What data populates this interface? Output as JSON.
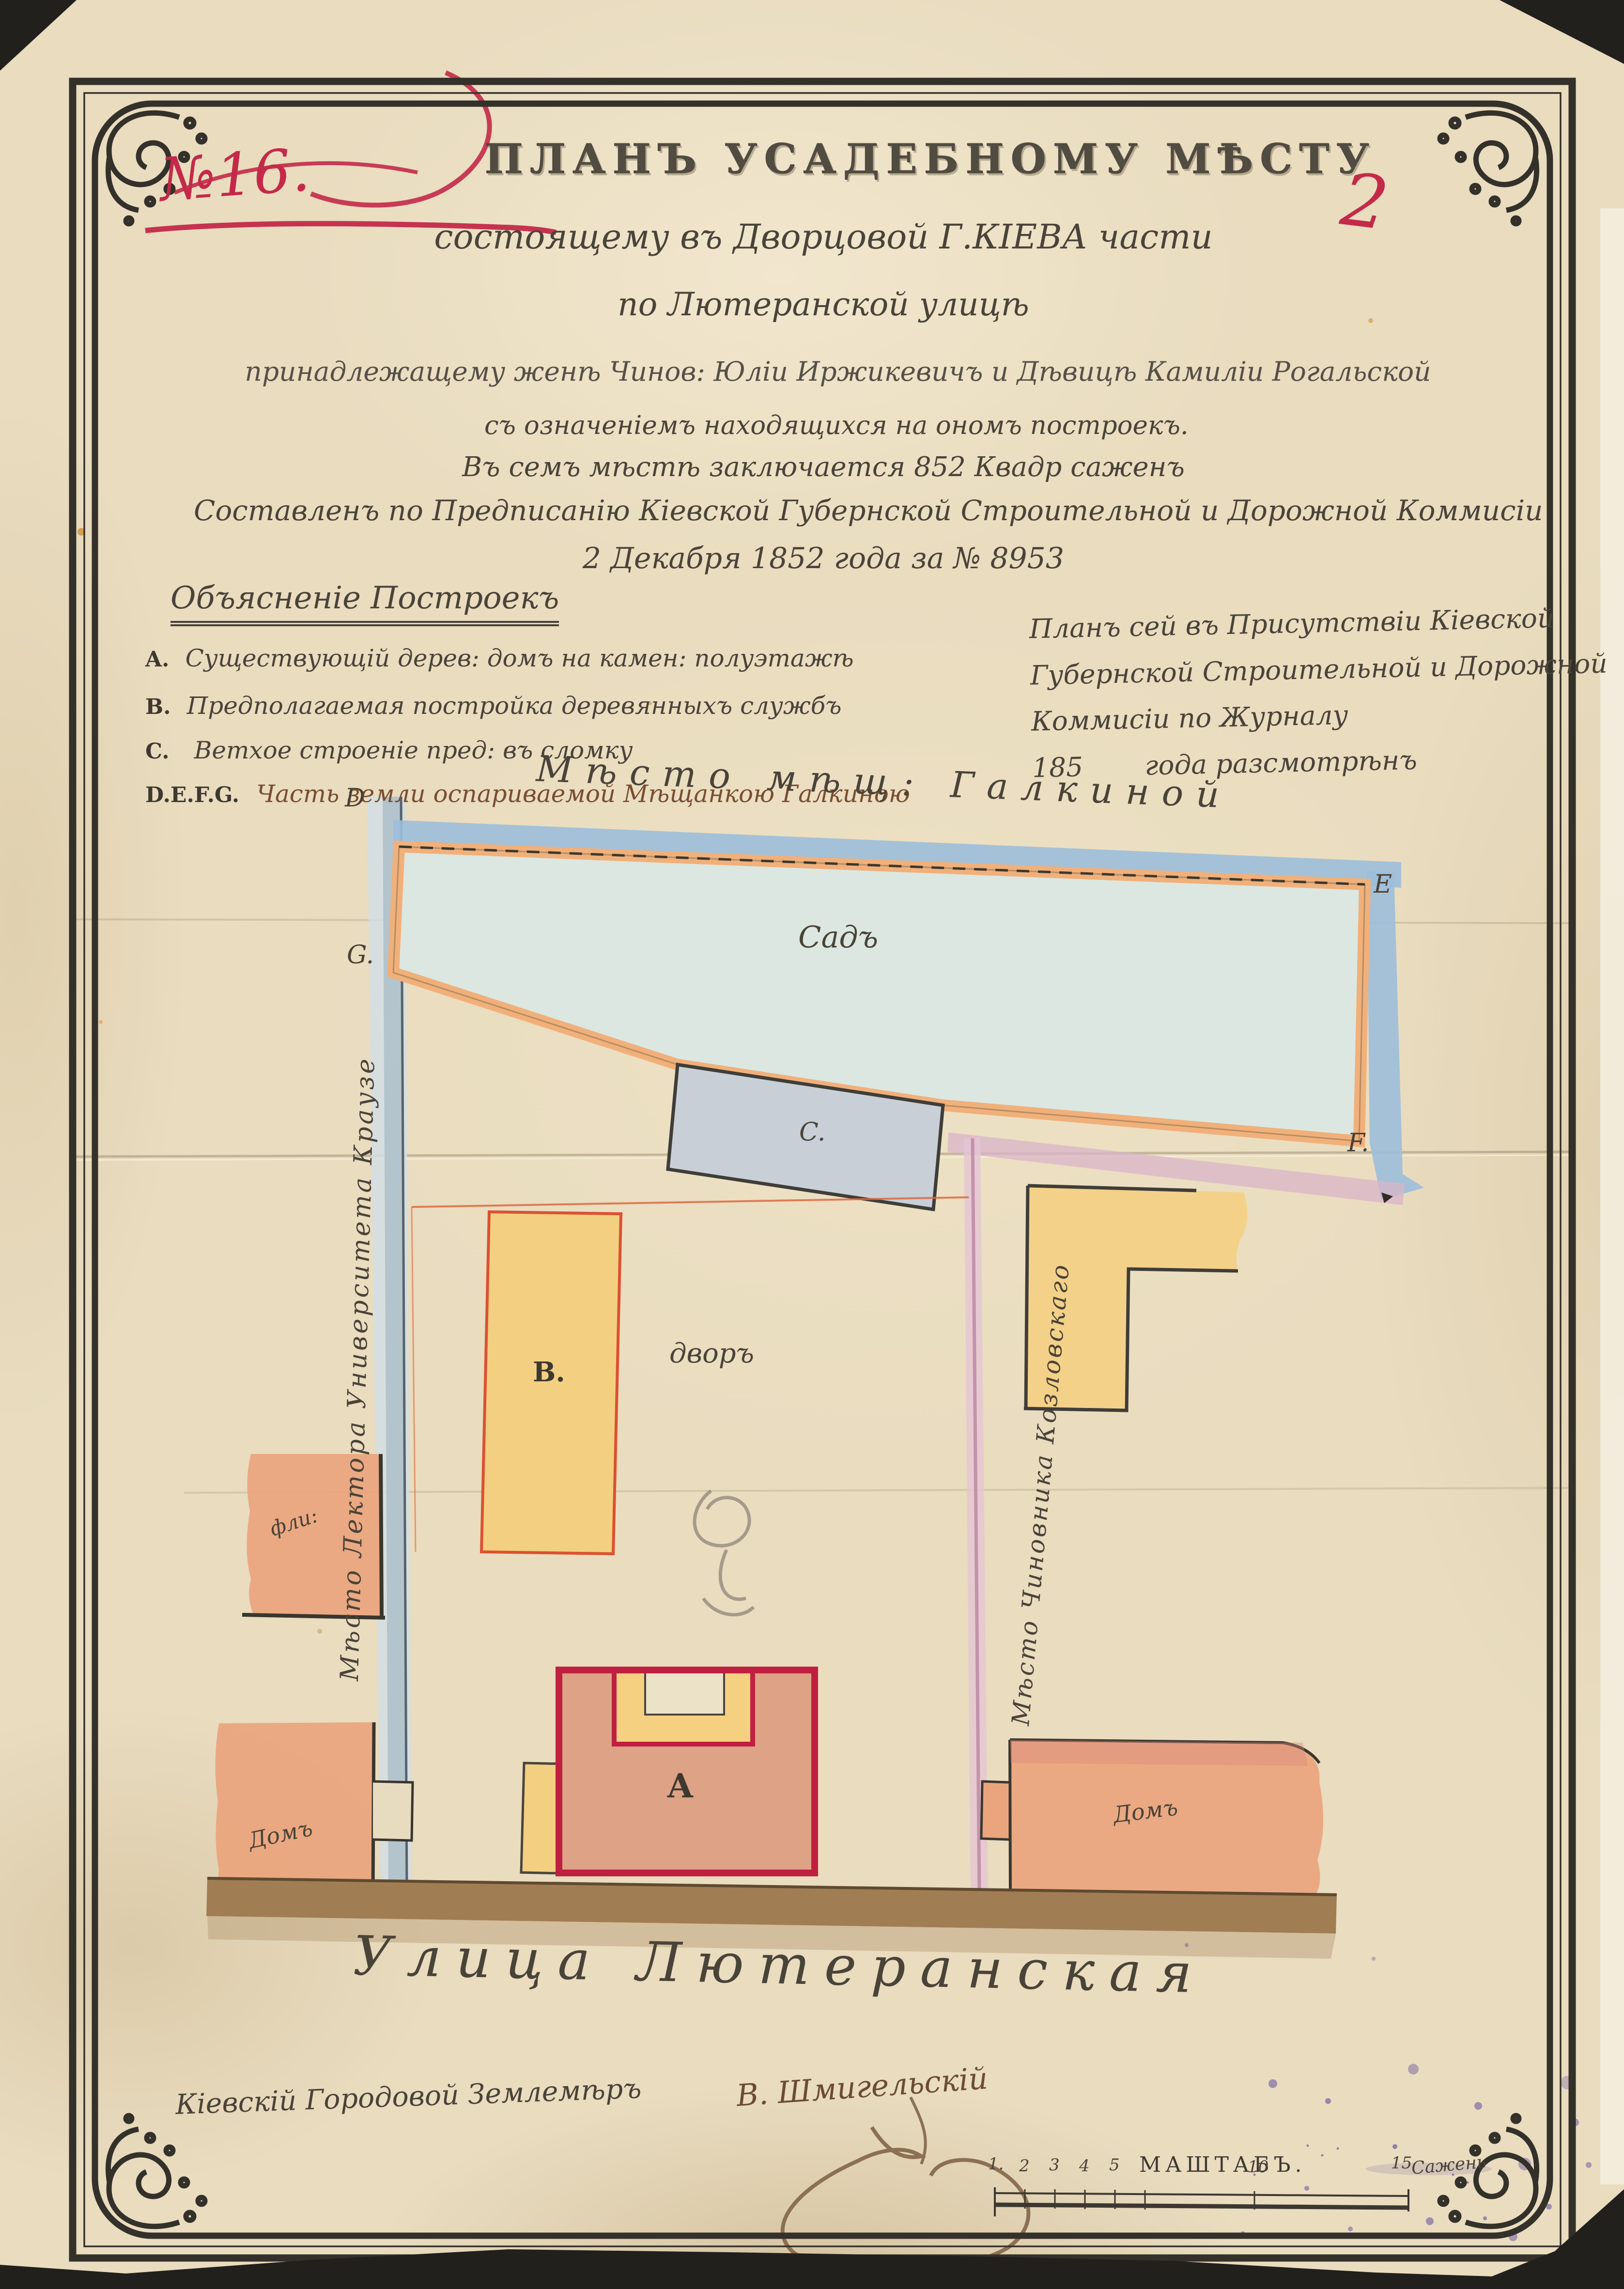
{
  "page": {
    "sheet_number": "2",
    "case_number": "№16."
  },
  "header": {
    "title": "ПЛАНЪ УСАДЕБНОМУ МѢСТУ",
    "line1": "состоящему въ Дворцовой Г.КІЕВА части",
    "line2": "по Лютеранской улицѣ",
    "line3": "принадлежащему женѣ Чинов: Юліи Иржикевичъ и Дѣвицѣ Камиліи Рогальской",
    "line4": "съ означеніемъ находящихся на ономъ построекъ.",
    "line5": "Въ семъ мѣстѣ заключается 852 Квадр саженъ",
    "line6": "Составленъ по Предписанію Кіевской Губернской Строительной и Дорожной Коммисіи",
    "line7": "2 Декабря 1852 года за № 8953"
  },
  "legend": {
    "heading": "Объясненіе Построекъ",
    "items": [
      {
        "key": "A.",
        "text": "Существующій дерев: домъ на камен: полуэтажѣ"
      },
      {
        "key": "B.",
        "text": "Предполагаемая постройка деревянныхъ службъ"
      },
      {
        "key": "C.",
        "text": "Ветхое строеніе пред: въ сломку"
      },
      {
        "key": "D.E.F.G.",
        "text": "Часть земли оспариваемой Мѣщанкою Галкиною"
      }
    ]
  },
  "review_note": {
    "line1": "Планъ сей въ Присутствіи Кіевской",
    "line2": "Губернской Строительной и Дорожной",
    "line3": "Коммисіи по Журналу",
    "year": "185",
    "line4": "года разсмотрѣнъ"
  },
  "plan": {
    "neighbor_top": "Мѣсто мѣщ: Галкиной",
    "neighbor_left": "Мѣсто Лектора Университета Краузе",
    "neighbor_right": "Мѣсто Чиновника Козловскаго",
    "garden_label": "Садъ",
    "yard_label": "дворъ",
    "street_label": "Улица Лютеранская",
    "corner_d": "D",
    "corner_e": "E",
    "corner_g": "G.",
    "corner_f": "F.",
    "building_a": "A",
    "building_b": "B.",
    "building_c": "C.",
    "left_wing_label": "фли:",
    "left_house_label": "Домъ",
    "right_house_label": "Домъ"
  },
  "footer": {
    "surveyor_label": "Кіевскій Городовой Землемѣръ",
    "surveyor_signature": "В. Шмигельскій",
    "scale_label": "МАШТАБЪ.",
    "scale_unit": "Сажень",
    "scale_ticks": [
      "1.",
      "2",
      "3",
      "4",
      "5",
      "10",
      "15"
    ]
  },
  "colors": {
    "paper": "#e9dcbf",
    "frame_ink": "#34302a",
    "red_ink": "#c42948",
    "text_ink": "#4a4338",
    "brown_ink": "#7a4e31",
    "garden_fill": "#dce7e1",
    "orange_band": "#f1b07a",
    "blue_band": "#9cbeda",
    "gray_building": "#c8cfd7",
    "yellow_building": "#f3cf82",
    "red_orange": "#dc5130",
    "house_a_fill": "#dea287",
    "house_a_border": "#c02040",
    "salmon": "#eaa57e",
    "pink_line": "#c9a3b5",
    "street_brown": "#a07d53",
    "purple_ink": "#54409b"
  }
}
